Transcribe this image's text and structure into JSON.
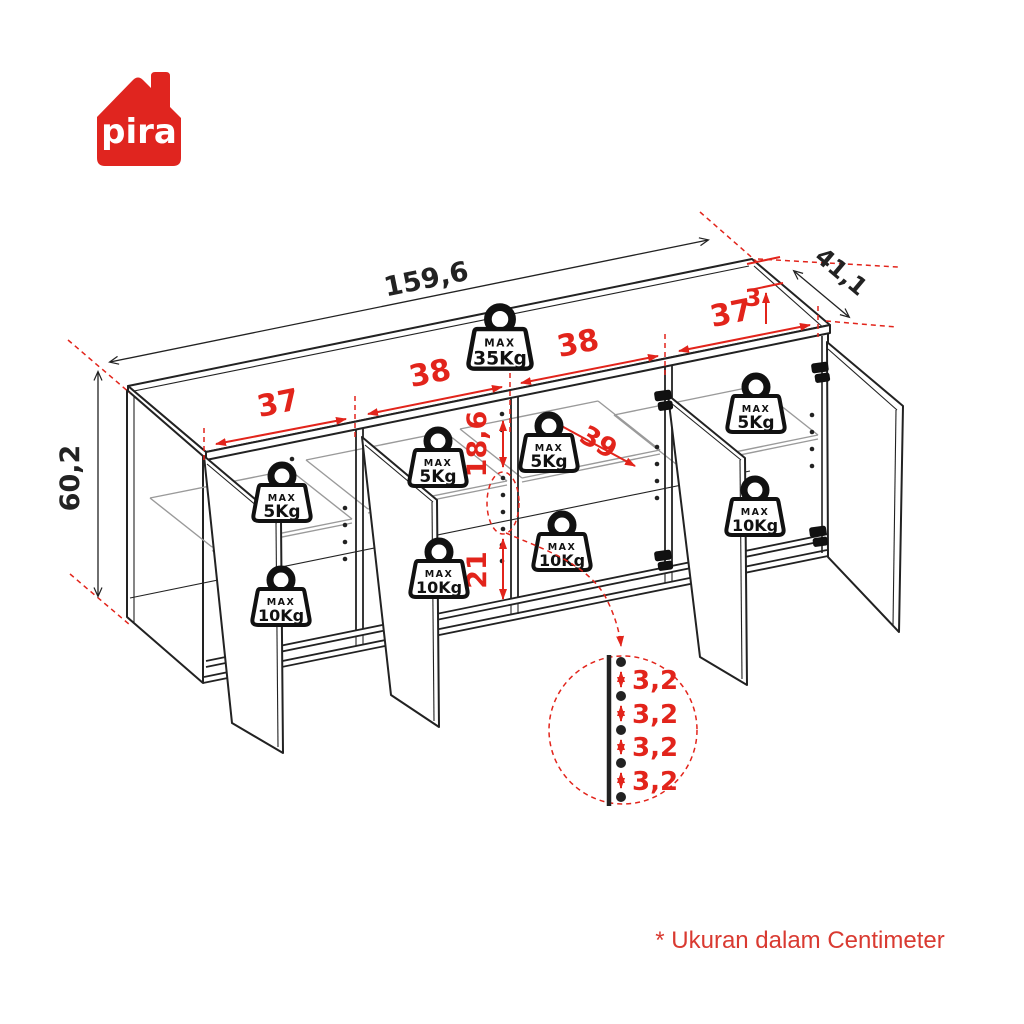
{
  "brand": {
    "logo_text": "pira",
    "logo_bg": "#e0251f",
    "logo_fg": "#ffffff"
  },
  "colors": {
    "line": "#222222",
    "dimension_red": "#e2241b",
    "shelf_gray": "#9a9a9a"
  },
  "diagram": {
    "type": "furniture-assembly-dimension-drawing",
    "subject": "4-door sideboard cabinet, isometric view with open doors",
    "units_footnote": "* Ukuran dalam Centimeter"
  },
  "labels": {
    "overall_width": "159,6",
    "depth": "41,1",
    "top_thickness": "3",
    "height": "60,2",
    "compartments": [
      "37",
      "38",
      "38",
      "37"
    ],
    "shelf_clearance": "18,6",
    "shelf_depth": "39",
    "lower_clearance": "21",
    "hole_spacing": [
      "3,2",
      "3,2",
      "3,2",
      "3,2"
    ]
  },
  "weights": {
    "max_label": "MAX",
    "top": "35Kg",
    "shelf": "5Kg",
    "bottom": "10Kg"
  }
}
